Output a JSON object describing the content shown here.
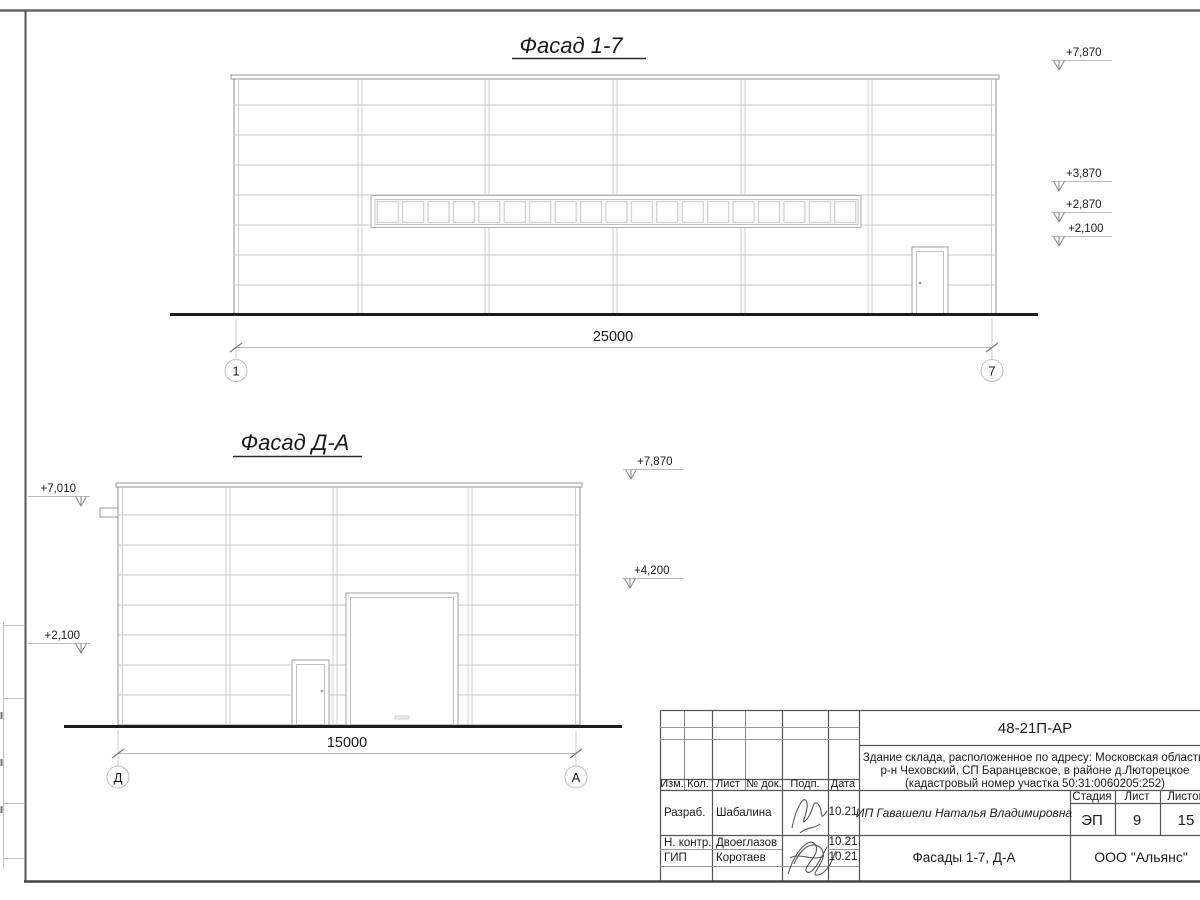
{
  "colors": {
    "ink": "#1a1a1a",
    "panel_line": "#c9c9c9",
    "wall_line": "#9a9a9a",
    "ground": "#1c1c1c",
    "frame": "#555555"
  },
  "facade_17": {
    "title": "Фасад 1-7",
    "dim": "25000",
    "axis_start": "1",
    "axis_end": "7",
    "levels": [
      "+7,870",
      "+3,870",
      "+2,870",
      "+2,100"
    ]
  },
  "facade_da": {
    "title": "Фасад Д-А",
    "dim": "15000",
    "axis_start": "Д",
    "axis_end": "А",
    "levels_left": [
      "+7,010",
      "+2,100"
    ],
    "levels_right": [
      "+7,870",
      "+4,200"
    ]
  },
  "titleblock": {
    "doc_code": "48-21П-АР",
    "address1": "Здание склада, расположенное по адресу: Московская область,",
    "address2": "р-н Чеховский, СП Баранцевское, в районе д.Люторецкое",
    "address3": "(кадастровый номер участка 50:31:0060205:252)",
    "cols": [
      "Изм.",
      "Кол.",
      "Лист",
      "№ док.",
      "Подп.",
      "Дата"
    ],
    "stage_cols": [
      "Стадия",
      "Лист",
      "Листов"
    ],
    "stage": "ЭП",
    "sheet_no": "9",
    "sheets_total": "15",
    "client": "ИП Гавашели Наталья Владимировна",
    "sheet_name": "Фасады 1-7, Д-А",
    "company": "ООО \"Альянс\"",
    "rows": [
      {
        "role": "Разраб.",
        "name": "Шабалина",
        "date": "10.21"
      },
      {
        "role": "Н. контр.",
        "name": "Двоеглазов",
        "date": "10.21"
      },
      {
        "role": "ГИП",
        "name": "Коротаев",
        "date": "10.21"
      }
    ]
  }
}
